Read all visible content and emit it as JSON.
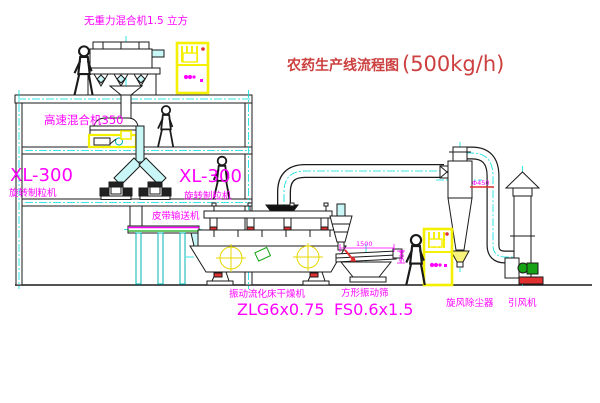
{
  "title": {
    "text": "农药生产线流程图",
    "capacity": "(500kg/h)"
  },
  "equipment_labels": {
    "zero_gravity_mixer": "无重力混合机1.5 立方",
    "high_speed_mixer": "高速混合机350",
    "granulator_left": {
      "model": "XL-300",
      "name": "旋转制粒机"
    },
    "granulator_center": {
      "model": "XL-300",
      "name": "旋转制粒机"
    },
    "belt_conveyor": "皮带输送机",
    "fluid_bed_dryer": {
      "name": "振动流化床干燥机",
      "model": "ZLG6x0.75"
    },
    "square_sieve": {
      "name": "方形振动筛",
      "model": "FS0.6x1.5"
    },
    "cyclone": "旋风除尘器",
    "induced_draft_fan": "引风机"
  },
  "dimensions": {
    "sieve_width": "1500",
    "sieve_height": "500",
    "cyclone_dia": "Φ450"
  },
  "colors": {
    "line": "#1a1a1a",
    "label_magenta": "#ff00ff",
    "title_red": "#cd4040",
    "centerline_cyan": "#00dede",
    "highlight_yellow": "#f5ef00",
    "accent_green": "#15a315",
    "accent_red": "#e03030"
  }
}
